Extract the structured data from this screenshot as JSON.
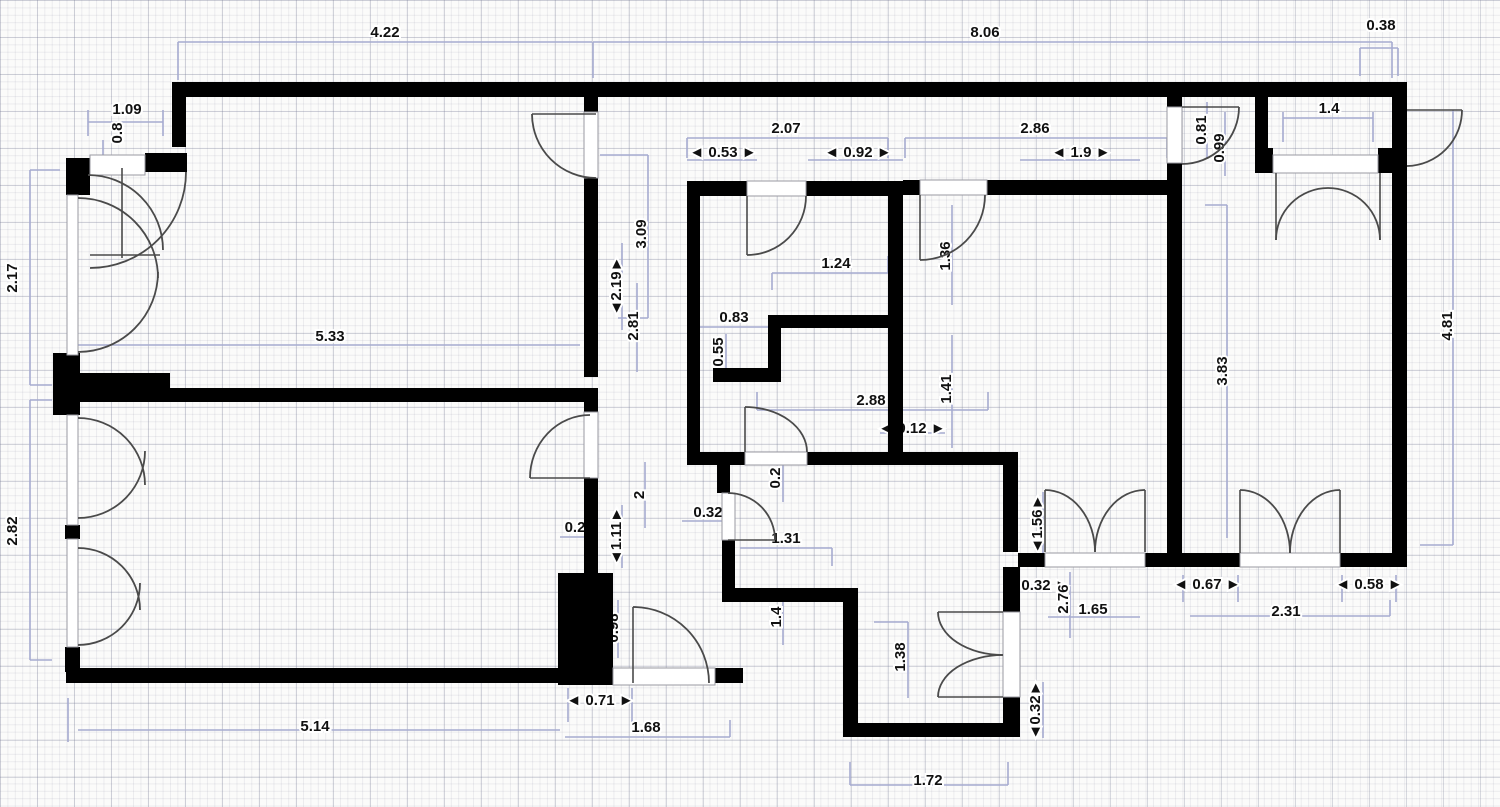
{
  "canvas": {
    "width": 1500,
    "height": 807
  },
  "colors": {
    "wall": "#000000",
    "dimension_line": "#a6abd0",
    "door_arc": "#4a4a4a",
    "label_text": "#111111",
    "background": "#fbfbfa",
    "grid_minor": "rgba(130,130,155,0.13)",
    "grid_major": "rgba(120,125,150,0.28)"
  },
  "walls": [
    [
      172,
      82,
      1235,
      15
    ],
    [
      172,
      97,
      14,
      50
    ],
    [
      66,
      158,
      24,
      37
    ],
    [
      145,
      153,
      42,
      19
    ],
    [
      53,
      353,
      27,
      62
    ],
    [
      65,
      525,
      15,
      14
    ],
    [
      65,
      647,
      15,
      25
    ],
    [
      67,
      373,
      103,
      17
    ],
    [
      53,
      388,
      545,
      14
    ],
    [
      66,
      668,
      567,
      15
    ],
    [
      710,
      668,
      33,
      15
    ],
    [
      584,
      97,
      14,
      15
    ],
    [
      584,
      178,
      14,
      199
    ],
    [
      584,
      390,
      14,
      22
    ],
    [
      584,
      478,
      14,
      95
    ],
    [
      558,
      573,
      55,
      112
    ],
    [
      687,
      181,
      60,
      15
    ],
    [
      806,
      181,
      97,
      15
    ],
    [
      687,
      181,
      13,
      284
    ],
    [
      888,
      181,
      15,
      284
    ],
    [
      770,
      315,
      118,
      13
    ],
    [
      768,
      315,
      13,
      55
    ],
    [
      713,
      368,
      68,
      14
    ],
    [
      687,
      452,
      58,
      13
    ],
    [
      807,
      452,
      96,
      13
    ],
    [
      717,
      465,
      13,
      28
    ],
    [
      722,
      540,
      13,
      62
    ],
    [
      903,
      452,
      115,
      13
    ],
    [
      1003,
      465,
      15,
      87
    ],
    [
      1003,
      567,
      17,
      45
    ],
    [
      1003,
      697,
      17,
      38
    ],
    [
      843,
      723,
      177,
      14
    ],
    [
      843,
      602,
      15,
      135
    ],
    [
      722,
      588,
      136,
      14
    ],
    [
      903,
      180,
      17,
      15
    ],
    [
      987,
      180,
      180,
      15
    ],
    [
      1167,
      97,
      15,
      10
    ],
    [
      1167,
      163,
      15,
      404
    ],
    [
      1255,
      85,
      13,
      63
    ],
    [
      1255,
      148,
      18,
      25
    ],
    [
      1378,
      148,
      29,
      25
    ],
    [
      1392,
      82,
      15,
      485
    ],
    [
      1018,
      553,
      27,
      14
    ],
    [
      1145,
      553,
      95,
      14
    ],
    [
      1340,
      553,
      67,
      14
    ]
  ],
  "openings": [
    [
      90,
      155,
      55,
      20
    ],
    [
      67,
      195,
      11,
      160
    ],
    [
      67,
      415,
      11,
      110
    ],
    [
      67,
      539,
      11,
      108
    ],
    [
      584,
      112,
      14,
      66
    ],
    [
      747,
      181,
      59,
      15
    ],
    [
      920,
      180,
      67,
      15
    ],
    [
      1167,
      107,
      15,
      56
    ],
    [
      1273,
      155,
      105,
      18
    ],
    [
      745,
      452,
      62,
      13
    ],
    [
      722,
      493,
      13,
      47
    ],
    [
      584,
      412,
      14,
      66
    ],
    [
      613,
      668,
      102,
      17
    ],
    [
      1045,
      553,
      100,
      14
    ],
    [
      1240,
      553,
      100,
      14
    ],
    [
      1003,
      612,
      17,
      85
    ]
  ],
  "door_arcs": [
    "M 88 175 A 75 75 0 0 1 163 250",
    "M 186 172 A 96 96 0 0 1 90 268",
    "M 532 114 A 64 64 0 0 0 596 178",
    "M 78 198 A 80 80 0 0 1 158 278",
    "M 78 352 A 80 80 0 0 0 158 272",
    "M 78 418 A 67 67 0 0 1 145 485",
    "M 78 518 A 67 67 0 0 0 145 451",
    "M 78 548 A 62 62 0 0 1 140 610",
    "M 78 645 A 62 62 0 0 0 140 583",
    "M 747 255 A 59 59 0 0 0 806 196",
    "M 920 260 A 65 65 0 0 0 985 195",
    "M 1239 107 A 57 57 0 0 1 1182 164",
    "M 1276 240 A 52 52 0 0 1 1328 188",
    "M 1380 240 A 52 52 0 0 0 1328 188",
    "M 1045 490 A 50 62 0 0 1 1095 552",
    "M 1145 490 A 50 62 0 0 0 1095 552",
    "M 1240 490 A 50 63 0 0 1 1290 553",
    "M 1340 490 A 50 63 0 0 0 1290 553",
    "M 938 612 A 65 43 0 0 0 1003 655",
    "M 938 697 A 65 42 0 0 1 1003 655",
    "M 633 607 A 76 76 0 0 1 709 683",
    "M 775 540 A 47 47 0 0 0 728 493",
    "M 745 407 A 62 45 0 0 1 807 452",
    "M 530 478 A 60 63 0 0 1 590 415",
    "M 1462 110 A 56 56 0 0 1 1407 166"
  ],
  "door_leaves": [
    [
      122,
      168,
      122,
      258
    ],
    [
      90,
      255,
      160,
      255
    ],
    [
      532,
      114,
      596,
      114
    ],
    [
      747,
      196,
      747,
      255
    ],
    [
      920,
      195,
      920,
      260
    ],
    [
      1182,
      107,
      1239,
      107
    ],
    [
      1276,
      173,
      1276,
      240
    ],
    [
      1380,
      173,
      1380,
      240
    ],
    [
      1045,
      490,
      1045,
      552
    ],
    [
      1145,
      490,
      1145,
      552
    ],
    [
      1240,
      490,
      1240,
      553
    ],
    [
      1340,
      490,
      1340,
      553
    ],
    [
      938,
      612,
      1003,
      612
    ],
    [
      938,
      697,
      1003,
      697
    ],
    [
      633,
      607,
      633,
      683
    ],
    [
      728,
      540,
      775,
      540
    ],
    [
      745,
      407,
      745,
      452
    ],
    [
      530,
      478,
      590,
      478
    ],
    [
      1407,
      110,
      1462,
      110
    ]
  ],
  "dimension_lines": [
    [
      178,
      42,
      592,
      42
    ],
    [
      178,
      42,
      178,
      80
    ],
    [
      593,
      42,
      593,
      78
    ],
    [
      593,
      42,
      1392,
      42
    ],
    [
      1392,
      42,
      1392,
      78
    ],
    [
      1360,
      48,
      1398,
      48
    ],
    [
      1360,
      48,
      1360,
      76
    ],
    [
      1398,
      48,
      1398,
      76
    ],
    [
      30,
      170,
      30,
      385
    ],
    [
      30,
      170,
      60,
      170
    ],
    [
      30,
      385,
      52,
      385
    ],
    [
      30,
      400,
      30,
      660
    ],
    [
      30,
      400,
      52,
      400
    ],
    [
      30,
      660,
      52,
      660
    ],
    [
      88,
      122,
      163,
      122
    ],
    [
      88,
      110,
      88,
      136
    ],
    [
      163,
      110,
      163,
      136
    ],
    [
      103,
      140,
      103,
      162
    ],
    [
      78,
      345,
      580,
      345
    ],
    [
      648,
      155,
      648,
      318
    ],
    [
      600,
      155,
      648,
      155
    ],
    [
      618,
      318,
      648,
      318
    ],
    [
      622,
      243,
      622,
      330
    ],
    [
      637,
      283,
      637,
      372
    ],
    [
      687,
      138,
      888,
      138
    ],
    [
      687,
      138,
      687,
      158
    ],
    [
      888,
      138,
      888,
      158
    ],
    [
      687,
      160,
      757,
      160
    ],
    [
      808,
      160,
      903,
      160
    ],
    [
      905,
      138,
      1167,
      138
    ],
    [
      905,
      138,
      905,
      158
    ],
    [
      1167,
      138,
      1167,
      158
    ],
    [
      1020,
      160,
      1140,
      160
    ],
    [
      772,
      273,
      888,
      273
    ],
    [
      772,
      273,
      772,
      290
    ],
    [
      888,
      256,
      888,
      273
    ],
    [
      690,
      327,
      775,
      327
    ],
    [
      690,
      327,
      690,
      345
    ],
    [
      726,
      334,
      726,
      372
    ],
    [
      952,
      205,
      952,
      305
    ],
    [
      952,
      335,
      952,
      448
    ],
    [
      757,
      410,
      988,
      410
    ],
    [
      757,
      392,
      757,
      410
    ],
    [
      988,
      392,
      988,
      410
    ],
    [
      880,
      433,
      945,
      433
    ],
    [
      1227,
      205,
      1227,
      538
    ],
    [
      1205,
      205,
      1227,
      205
    ],
    [
      1453,
      110,
      1453,
      545
    ],
    [
      1420,
      545,
      1453,
      545
    ],
    [
      1207,
      102,
      1207,
      158
    ],
    [
      1225,
      112,
      1225,
      176
    ],
    [
      1283,
      118,
      1373,
      118
    ],
    [
      1283,
      112,
      1283,
      142
    ],
    [
      1373,
      112,
      1373,
      142
    ],
    [
      783,
      452,
      783,
      502
    ],
    [
      682,
      521,
      735,
      521
    ],
    [
      740,
      548,
      832,
      548
    ],
    [
      832,
      548,
      832,
      566
    ],
    [
      645,
      462,
      645,
      528
    ],
    [
      622,
      505,
      622,
      568
    ],
    [
      560,
      537,
      592,
      537
    ],
    [
      618,
      600,
      618,
      658
    ],
    [
      783,
      592,
      783,
      645
    ],
    [
      568,
      688,
      568,
      722
    ],
    [
      632,
      688,
      632,
      722
    ],
    [
      565,
      737,
      730,
      737
    ],
    [
      730,
      720,
      730,
      737
    ],
    [
      78,
      730,
      560,
      730
    ],
    [
      68,
      698,
      68,
      742
    ],
    [
      908,
      622,
      908,
      698
    ],
    [
      874,
      622,
      908,
      622
    ],
    [
      1070,
      572,
      1070,
      638
    ],
    [
      1048,
      617,
      1140,
      617
    ],
    [
      1043,
      492,
      1043,
      558
    ],
    [
      1043,
      682,
      1043,
      738
    ],
    [
      1183,
      575,
      1183,
      602
    ],
    [
      1238,
      575,
      1238,
      602
    ],
    [
      1190,
      616,
      1390,
      616
    ],
    [
      1390,
      600,
      1390,
      616
    ],
    [
      1342,
      575,
      1342,
      602
    ],
    [
      1396,
      575,
      1396,
      602
    ],
    [
      850,
      785,
      1008,
      785
    ],
    [
      850,
      762,
      850,
      785
    ],
    [
      1008,
      762,
      1008,
      785
    ]
  ],
  "labels": [
    {
      "text": "4.22",
      "x": 385,
      "y": 37,
      "rot": 0
    },
    {
      "text": "8.06",
      "x": 985,
      "y": 37,
      "rot": 0
    },
    {
      "text": "0.38",
      "x": 1381,
      "y": 30,
      "rot": 0
    },
    {
      "text": "1.09",
      "x": 127,
      "y": 114,
      "rot": 0
    },
    {
      "text": "0.8",
      "x": 122,
      "y": 133,
      "rot": -90
    },
    {
      "text": "2.17",
      "x": 17,
      "y": 278,
      "rot": -90
    },
    {
      "text": "2.82",
      "x": 17,
      "y": 531,
      "rot": -90
    },
    {
      "text": "5.33",
      "x": 330,
      "y": 341,
      "rot": 0
    },
    {
      "text": "5.14",
      "x": 315,
      "y": 731,
      "rot": 0
    },
    {
      "text": "2.07",
      "x": 786,
      "y": 133,
      "rot": 0
    },
    {
      "text": "◄ 0.53 ►",
      "x": 723,
      "y": 157,
      "rot": 0
    },
    {
      "text": "◄ 0.92 ►",
      "x": 858,
      "y": 157,
      "rot": 0
    },
    {
      "text": "2.86",
      "x": 1035,
      "y": 133,
      "rot": 0
    },
    {
      "text": "◄ 1.9 ►",
      "x": 1081,
      "y": 157,
      "rot": 0
    },
    {
      "text": "3.09",
      "x": 646,
      "y": 234,
      "rot": -90
    },
    {
      "text": "◄2.19►",
      "x": 621,
      "y": 286,
      "rot": -90
    },
    {
      "text": "2.81",
      "x": 638,
      "y": 326,
      "rot": -90
    },
    {
      "text": "1.24",
      "x": 836,
      "y": 268,
      "rot": 0
    },
    {
      "text": "0.83",
      "x": 734,
      "y": 322,
      "rot": 0
    },
    {
      "text": "0.55",
      "x": 723,
      "y": 352,
      "rot": -90
    },
    {
      "text": "1.36",
      "x": 950,
      "y": 256,
      "rot": -90
    },
    {
      "text": "1.41",
      "x": 951,
      "y": 389,
      "rot": -90
    },
    {
      "text": "2.88",
      "x": 871,
      "y": 405,
      "rot": 0
    },
    {
      "text": "◄ 0.12 ►",
      "x": 912,
      "y": 433,
      "rot": 0
    },
    {
      "text": "0.81",
      "x": 1206,
      "y": 130,
      "rot": -90
    },
    {
      "text": "0.99",
      "x": 1224,
      "y": 148,
      "rot": -90
    },
    {
      "text": "1.4",
      "x": 1329,
      "y": 113,
      "rot": 0
    },
    {
      "text": "3.83",
      "x": 1227,
      "y": 371,
      "rot": -90
    },
    {
      "text": "4.81",
      "x": 1452,
      "y": 326,
      "rot": -90
    },
    {
      "text": "0.2",
      "x": 780,
      "y": 478,
      "rot": -90
    },
    {
      "text": "0.32",
      "x": 708,
      "y": 517,
      "rot": 0
    },
    {
      "text": "1.31",
      "x": 786,
      "y": 543,
      "rot": 0
    },
    {
      "text": "2",
      "x": 644,
      "y": 495,
      "rot": -90
    },
    {
      "text": "◄1.11►",
      "x": 621,
      "y": 536,
      "rot": -90
    },
    {
      "text": "0.2",
      "x": 575,
      "y": 532,
      "rot": 0
    },
    {
      "text": "0.98",
      "x": 618,
      "y": 628,
      "rot": -90
    },
    {
      "text": "1.4",
      "x": 781,
      "y": 617,
      "rot": -90
    },
    {
      "text": "◄ 0.71 ►",
      "x": 600,
      "y": 705,
      "rot": 0
    },
    {
      "text": "1.68",
      "x": 646,
      "y": 732,
      "rot": 0
    },
    {
      "text": "1.38",
      "x": 905,
      "y": 657,
      "rot": -90
    },
    {
      "text": "◄ 0.32 ►",
      "x": 1036,
      "y": 590,
      "rot": 0
    },
    {
      "text": "2.76",
      "x": 1068,
      "y": 599,
      "rot": -90
    },
    {
      "text": "1.65",
      "x": 1093,
      "y": 614,
      "rot": 0
    },
    {
      "text": "◄1.56►",
      "x": 1042,
      "y": 524,
      "rot": -90
    },
    {
      "text": "◄0.32►",
      "x": 1040,
      "y": 710,
      "rot": -90
    },
    {
      "text": "◄ 0.67 ►",
      "x": 1207,
      "y": 589,
      "rot": 0
    },
    {
      "text": "2.31",
      "x": 1286,
      "y": 616,
      "rot": 0
    },
    {
      "text": "◄ 0.58 ►",
      "x": 1369,
      "y": 589,
      "rot": 0
    },
    {
      "text": "1.72",
      "x": 928,
      "y": 785,
      "rot": 0
    }
  ]
}
